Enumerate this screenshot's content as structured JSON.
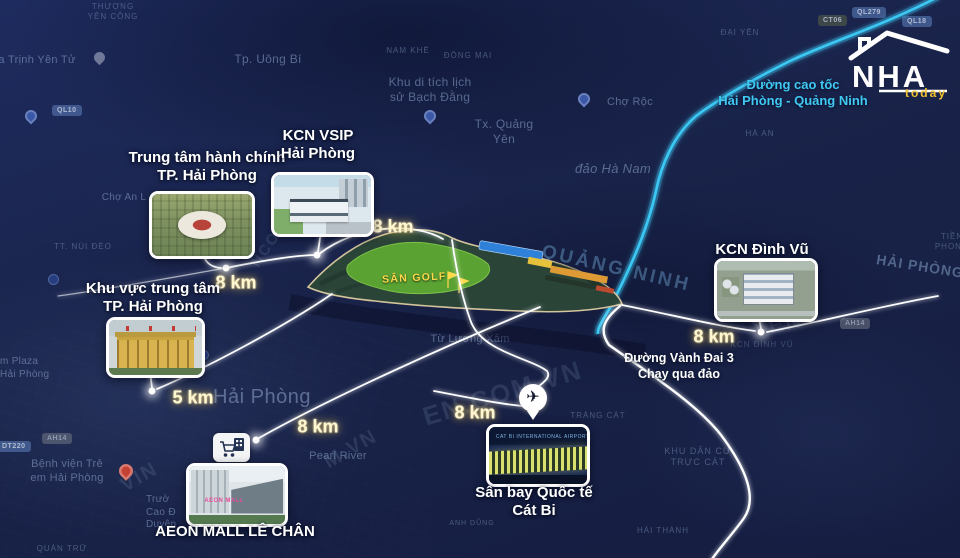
{
  "logo": {
    "name": "NHA",
    "sub": "today"
  },
  "colors": {
    "expressway": "#3fc9f3",
    "distance_text": "#fff7d0",
    "golf_label": "#ffd94a",
    "logo_sub": "#f0c030",
    "map_base": "#192349",
    "golf_green": "#5aa232"
  },
  "icons": {
    "airplane": "✈",
    "cart": "shopping-cart",
    "golf_flag": "flag"
  },
  "route_annotations": {
    "expressway": "Đường cao tốc\nHải Phòng - Quảng Ninh",
    "ringroad": "Đường Vành Đai 3\nChạy qua đảo"
  },
  "development": {
    "golf_label": "SÂN GOLF"
  },
  "landmarks": {
    "admin": {
      "label": "Trung tâm hành chính\nTP. Hải Phòng",
      "distance": "8 km"
    },
    "vsip": {
      "label": "KCN VSIP\nHải Phòng",
      "distance": "8 km"
    },
    "center": {
      "label": "Khu vực trung tâm\nTP. Hải Phòng",
      "distance": "5 km"
    },
    "dinhvu": {
      "label": "KCN Đình Vũ",
      "distance": "8 km"
    },
    "aeon": {
      "label": "AEON MALL LÊ CHÂN",
      "distance": "8 km",
      "sign": "AEON MALL"
    },
    "airport": {
      "label": "Sân bay Quốc tế\nCát Bi",
      "distance": "8 km",
      "sign": "CAT BI INTERNATIONAL AIRPORT"
    }
  },
  "province_labels": {
    "quang_ninh": "QUẢNG NINH",
    "hai_phong_edge": "HẢI PHÒNG"
  },
  "map_labels": {
    "thuong_yen_cong": "THƯỢNG\nYÊN CÔNG",
    "chua_trinh": "ua Trịnh Yên Tử",
    "uong_bi": "Tp. Uông Bí",
    "nam_khe": "NAM KHÊ",
    "dong_mai": "ĐÔNG MAI",
    "bach_dang": "Khu di tích lịch\nsử Bạch Đằng",
    "cho_roc": "Chợ Rộc",
    "quang_yen": "Tx. Quảng\nYên",
    "dao_ha_nam": "đảo Hà Nam",
    "ha_an": "HÀ AN",
    "dai_yen": "ĐẠI YÊN",
    "cho_an": "Chợ An L",
    "nui_deo": "TT. NÚI ĐÈO",
    "tien_phong": "TIỀN PHONG",
    "hai_phong_city": "Hải Phòng",
    "pearl_river": "Pearl River",
    "tu_luong_xam": "Từ Lương Xâm",
    "trang_cat": "TRÀNG CÁT",
    "anh_dung": "ANH DŨNG",
    "hai_thanh": "HẢI THÀNH",
    "truc_cat": "KHU DÂN CƯ\nTRỰC CÁT",
    "benh_vien": "Bệnh viện Trẻ\nem Hải Phòng",
    "plaza": "m Plaza\nHải Phòng",
    "quan_tru": "QUÁN TRỮ",
    "truong_cd": "Trườ\nCao Đ\nDuyên",
    "kcn_dinh_vu_map": "KCN ĐÌNH VŨ"
  },
  "badges": {
    "ql10": "QL10",
    "ql279": "QL279",
    "ql18": "QL18",
    "ct06": "CT06",
    "dt220": "DT220",
    "ah14_a": "AH14",
    "ah14_b": "AH14"
  },
  "watermarks": {
    "w1": "EN.COM.VN",
    "w2": "M.VN",
    "w3": "VIN",
    "w4": "NCOM.VN",
    "w5": "YÊN"
  }
}
